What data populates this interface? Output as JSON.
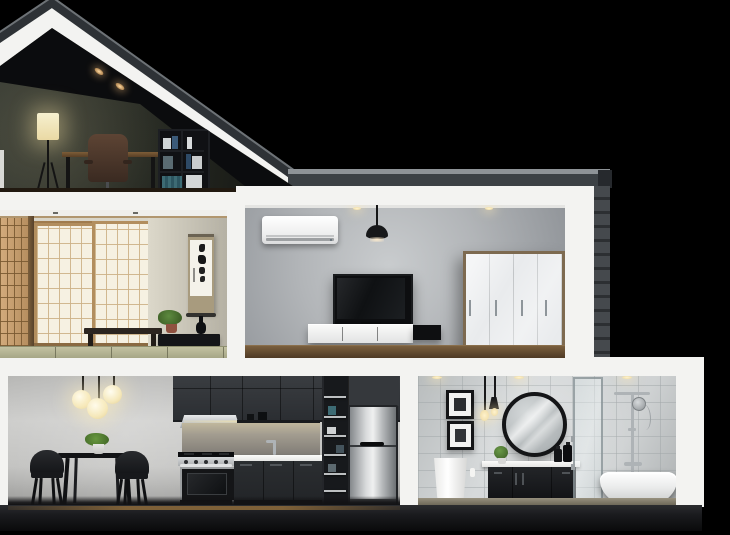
{
  "scene": {
    "type": "3d-render-photo",
    "title": "Night-time cutaway cross-section of a modern two-story house",
    "background": "black void",
    "scroll_calligraphy": "如雲内大",
    "rooms": [
      {
        "name": "attic-study",
        "objects": [
          "sloped-gable-roof",
          "recessed-spotlights",
          "floor-lamp",
          "wooden-desk",
          "brown-office-chair",
          "black-bookshelf-with-books"
        ]
      },
      {
        "name": "japanese-room",
        "objects": [
          "shoji-screens",
          "wood-post",
          "hanging-calligraphy-scroll",
          "low-wood-bench",
          "potted-plant",
          "black-ikebana-vase",
          "low-black-cabinet",
          "tatami-floor"
        ]
      },
      {
        "name": "living-room",
        "objects": [
          "air-conditioner",
          "black-pendant-lamp",
          "wall-mounted-tv",
          "floating-media-console",
          "four-door-wardrobe",
          "wood-floor"
        ]
      },
      {
        "name": "dining-area",
        "objects": [
          "three-globe-pendants",
          "black-dining-table",
          "table-plant",
          "two-black-shell-chairs"
        ]
      },
      {
        "name": "kitchen",
        "objects": [
          "charcoal-upper-cabinets",
          "range-hood",
          "under-cabinet-light",
          "backsplash",
          "faucet",
          "white-countertop",
          "stainless-range-oven",
          "charcoal-base-cabinets",
          "open-shelf-tower",
          "stainless-refrigerator"
        ]
      },
      {
        "name": "bathroom",
        "objects": [
          "two-framed-artworks",
          "hanging-filament-bulbs",
          "round-black-mirror",
          "pedestal-basin",
          "black-vanity-with-white-top",
          "counter-plant",
          "black-bottles",
          "glass-shower-screen",
          "chrome-shower-column",
          "freestanding-bathtub"
        ]
      }
    ]
  },
  "colors": {
    "bg": "#000000",
    "structure": "#f3f3f1",
    "roof_dark": "#2e3236",
    "roof_cap": "#3c4145",
    "roof_cap_light": "#8e9397",
    "brick_wall": "#43474b",
    "attic_wall": "#2e312c",
    "warm_glow": "#ffe9b0",
    "shoji_paper": "#f6f1e2",
    "shoji_wood": "#b28e5e",
    "jp_wall": "#d9d5c8",
    "tatami": "#b9b897",
    "living_wall": "#b2b5b8",
    "wood_floor": "#5f4a31",
    "black_furniture": "#17181b",
    "cabinet_dark": "#2b2e31",
    "stainless_steel": "#c6c9cb",
    "tile": "#d4d7d8",
    "dining_wall": "#c7c7c5",
    "plinth": "#1e1f22"
  }
}
